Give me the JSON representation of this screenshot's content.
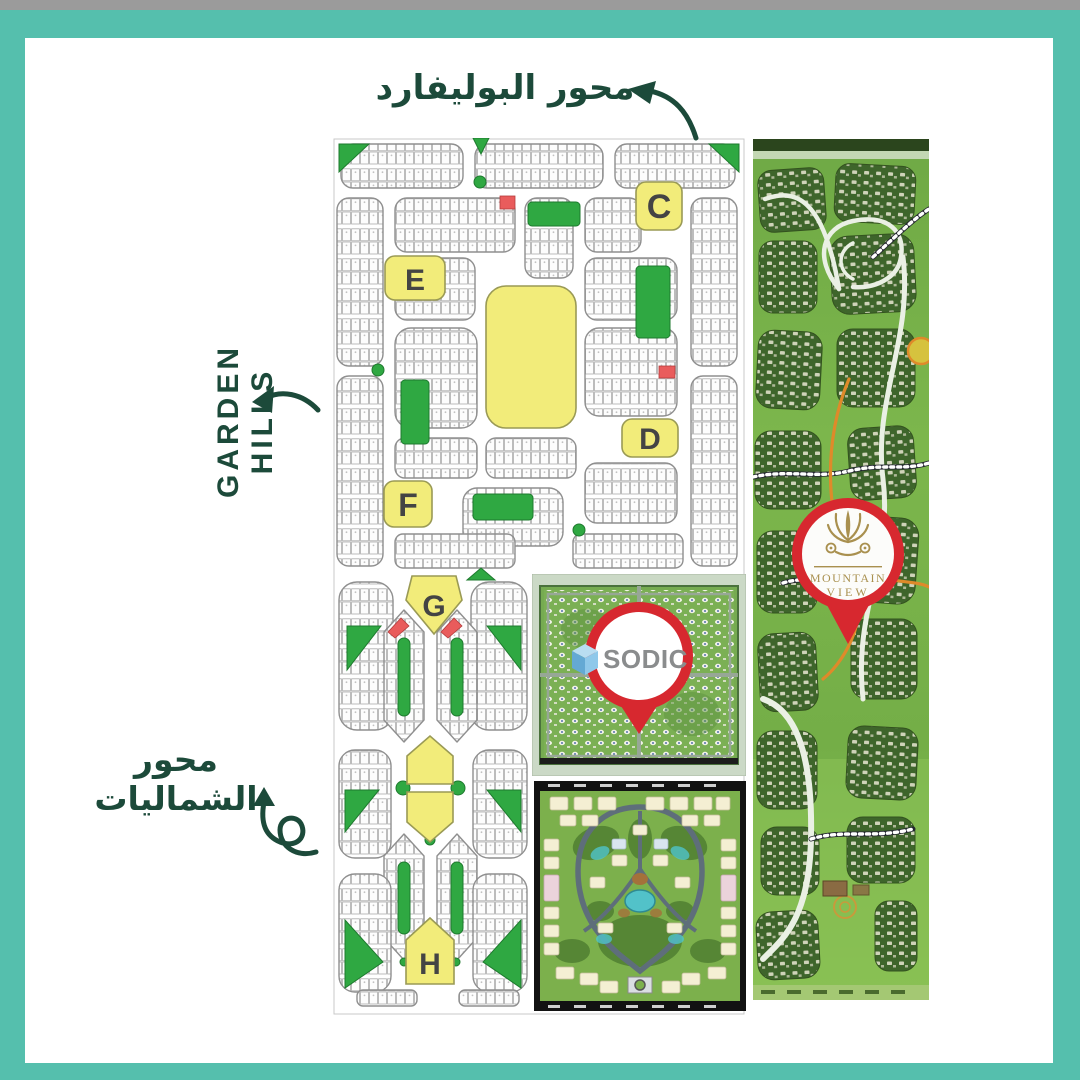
{
  "frame": {
    "teal": "#55BFAD",
    "topbar_gray": "#9B9B9B",
    "inner_bg": "#FFFFFF"
  },
  "labels": {
    "boulevard_axis": "محور البوليفارد",
    "garden_hills": "GARDEN HILLS",
    "northern_axis": "محور الشماليات",
    "text_color": "#1C4A3A"
  },
  "masterplan": {
    "zones": {
      "c": "C",
      "d": "D",
      "e": "E",
      "f": "F",
      "g": "G",
      "h": "H"
    },
    "colors": {
      "zone_yellow": "#F2EC7A",
      "park_green": "#2FA842",
      "plot_red": "#E95C5C",
      "road_gray": "#8F8F8F"
    }
  },
  "pins": {
    "sodic": {
      "label": "SODIC",
      "ring_color": "#D7282F",
      "cube_blue": "#8FC8EA",
      "text_gray": "#8A8C8D"
    },
    "mountain_view": {
      "line1": "MOUNTAIN",
      "line2": "VIEW",
      "ring_color": "#D7282F",
      "gold": "#A9904F"
    }
  }
}
